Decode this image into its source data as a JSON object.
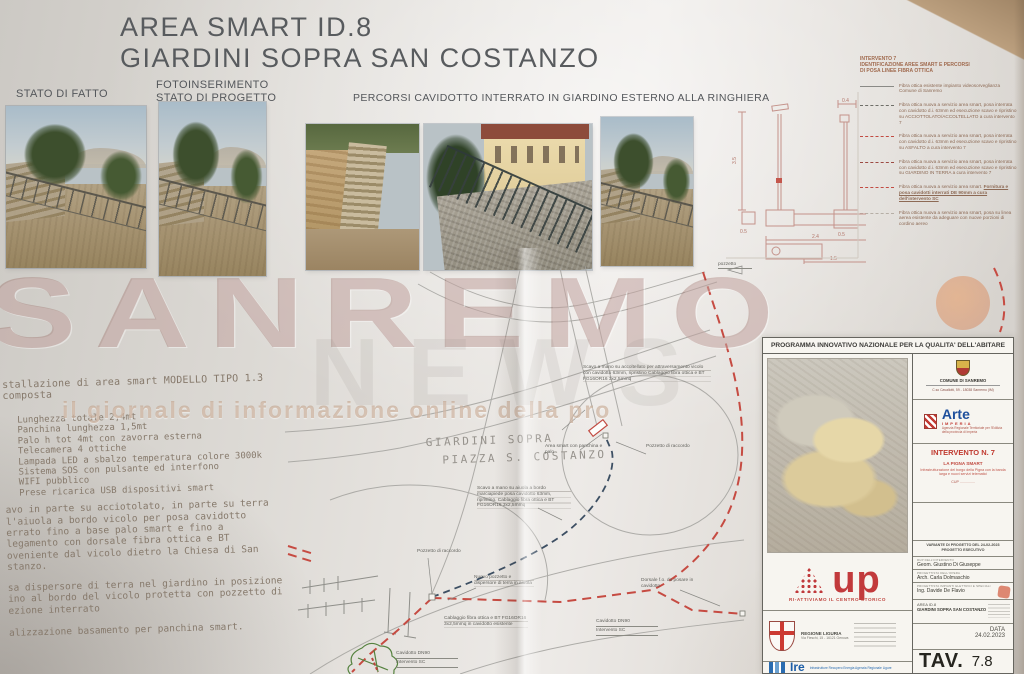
{
  "title": {
    "line1": "AREA SMART ID.8",
    "line2": "GIARDINI SOPRA SAN COSTANZO"
  },
  "photo_section": {
    "stato_label": "STATO DI FATTO",
    "foto_label1": "FOTOINSERIMENTO",
    "foto_label2": "STATO DI PROGETTO",
    "percorsi_label": "PERCORSI CAVIDOTTO INTERRATO IN GIARDINO ESTERNO ALLA RINGHIERA"
  },
  "legend": {
    "title": [
      "INTERVENTO 7",
      "IDENTIFICAZIONE AREE SMART E PERCORSI",
      "DI POSA LINEE FIBRA OTTICA"
    ],
    "items": [
      {
        "text": "Fibra ottica esistente impianto videosorveglianza Comune di Sanremo"
      },
      {
        "text": "Fibra ottica nuova a servizio area smart, posa interrata con cavidotto d.i. 63mm ed esecuzione scavo e ripristino su ACCIOTTOLATO/ACCOLTELLATO a cura intervento 7"
      },
      {
        "text": "Fibra ottica nuova a servizio area smart, posa interrata con cavidotto d.i. 63mm ed esecuzione scavo e ripristino su ASFALTO a cura intervento 7"
      },
      {
        "text": "Fibra ottica nuova a servizio area smart, posa interrata con cavidotto d.i. 63mm ed esecuzione scavo e ripristino su GIARDINO IN TERRA a cura intervento 7"
      },
      {
        "text": "Fibra ottica nuova a servizio area smart. ",
        "text_bold": "Fornitura e posa cavidotti interrati DE 90mm a cura dell'intervento SC"
      },
      {
        "text": "Fibra ottica nuova a servizio area smart, posa su linea aerea esistente da adeguare con nuove porzioni di cordino aereo"
      }
    ]
  },
  "diagram": {
    "dim_35": "3.5",
    "dim_04": "0.4",
    "dim_05": "0.5",
    "dim_24": "2.4",
    "dim_15": "1.5",
    "dim_05b": "0.5"
  },
  "watermark": {
    "main": "SANREMO",
    "sub": "NEWS",
    "tagline": "il giornale di informazione online della pro"
  },
  "specs": {
    "intro": "stallazione di area smart MODELLO TIPO 1.3 composta",
    "items": [
      "Lunghezza totale 2,4mt",
      "Panchina lunghezza 1,5mt",
      "Palo h tot 4mt con zavorra esterna",
      "Telecamera 4 ottiche",
      "Lampada LED a sbalzo temperatura colore 3000k",
      "Sistema SOS con pulsante ed interfono",
      "WIFI pubblico",
      "Prese ricarica USB dispositivi smart"
    ],
    "para2": [
      "avo in parte su acciotolato, in parte su terra",
      "l'aiuola a bordo vicolo per posa cavidotto",
      "errato fino a base palo smart e fino a",
      "legamento con dorsale fibra ottica e BT",
      "oveniente dal vicolo dietro la Chiesa di San",
      "stanzo."
    ],
    "para3": [
      "sa dispersore di terra nel giardino in posizione",
      "ino al bordo del vicolo protetta con pozzetto di",
      "ezione interrato"
    ],
    "para4": "alizzazione basamento per panchina smart."
  },
  "map": {
    "place1": "GIARDINI SOPRA",
    "place2": "PIAZZA S. COSTANZO",
    "area_smart": "Area smart con panchina e palo",
    "pozzetto1": "Pozzetto di raccordo",
    "pozzetto2": "Pozzetto di raccordo",
    "pozzetto_tiny": "pozzetto",
    "scavo1": "Scavo a mano su accoltellato per attraversamento vicolo con cavidotto 63mm, ripristino Cablaggio fibra ottica e BT FG16OR16 3x2,5mmq",
    "scavo2": "Scavo a mano su aiuola a bordo marciapiede posa cavidotto 63mm, ripristino. Cablaggio fibra ottica e BT FG16OR16 3x2,5mmq",
    "nuovo_pozzetto": "Nuovo pozzetto e dispersore di terra in aiuola",
    "cablaggio": "Cablaggio fibra ottica e BT FG16OR16 3x2,5mmq in cavidotto esistente",
    "cavidotto1a": "Cavidotto DN90",
    "cavidotto1b": "Intervento SC",
    "cavidotto2a": "Cavidotto DN90",
    "cavidotto2b": "Intervento SC",
    "dorsale": "Dorsale f.o. da posare in cavidotto"
  },
  "titleblock": {
    "header": "PROGRAMMA INNOVATIVO NAZIONALE PER LA QUALITA' DELL'ABITARE",
    "comune": {
      "name": "COMUNE DI SANREMO",
      "address": "C.so Cavallotti, 59 - 18038 Sanremo (IM)"
    },
    "arte": {
      "name": "Arte",
      "city": "IMPERIA",
      "line1": "Agenzia Regionale Territoriale per l'Edilizia",
      "line2": "della provincia di Imperia"
    },
    "intervento": {
      "title": "INTERVENTO N. 7",
      "sub": "LA PIGNA SMART",
      "desc": "Infrastrutturazione del borgo della Pigna con la banda larga e nuovi servizi telematici",
      "cup": "CUP ..............."
    },
    "variante": {
      "line1": "VARIANTE DI PROGETTO DEL 24-02-2023",
      "line2": "PROGETTO ESECUTIVO"
    },
    "roles": [
      {
        "label": "RUP DELL'INTERVENTO",
        "name": "Geom. Giustino Di Giuseppe"
      },
      {
        "label": "PROGETTISTA DELL'OPERA",
        "name": "Arch. Carla Dolmaschio"
      },
      {
        "label": "PROGETTISTA IMPIANTI ELETTRICI E SPECIALI",
        "name": "Ing. Davide De Flavio"
      }
    ],
    "area": {
      "line1": "AREA ID.8",
      "line2": "GIARDINI SOPRA SAN COSTANZO"
    },
    "data_label": "DATA",
    "data_value": "24.02.2023",
    "tav_label": "TAV.",
    "tav_value": "7.8",
    "up": {
      "slogan": "RI-ATTIVIAMO IL CENTRO STORICO",
      "word": "up"
    },
    "regione": {
      "name": "REGIONE LIGURIA",
      "address": "Via Fieschi, 15 - 16121 Genova"
    },
    "ire": {
      "word": "Ire",
      "desc": "Infrastrutture Recupero Energia Agenzia Regionale Ligure"
    }
  }
}
